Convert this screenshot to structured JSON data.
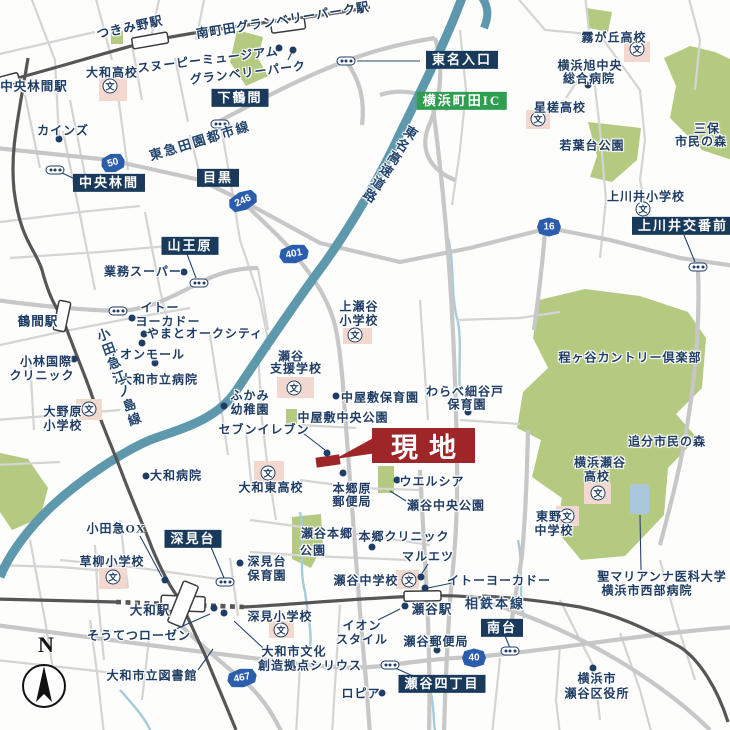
{
  "map": {
    "site": {
      "label": "現地"
    },
    "compass": {
      "label": "N"
    },
    "legend": {
      "school_char": "文"
    },
    "colors": {
      "site_red": "#9f2628",
      "label_navy": "#1e3c64",
      "box_navy": "#1a3a5c",
      "ic_green": "#2f9e50",
      "expressway_teal": "#5d98ac",
      "park_green": "#b4ca80",
      "road_gray": "#cfcfcf",
      "rail_gray": "#565656",
      "school_pink": "#f2d8ce",
      "hospital_blue": "#a9c6dd",
      "shield_blue": "#2b5dad"
    },
    "rail_road_labels": [
      {
        "text": "東急田園都市線",
        "x": 200,
        "y": 141,
        "rot": -17,
        "mode": "h"
      },
      {
        "text": "小田急江ノ島線",
        "x": 118,
        "y": 378,
        "rot": -20,
        "mode": "v"
      },
      {
        "text": "東名高速道路",
        "x": 389,
        "y": 164,
        "rot": 33,
        "mode": "v"
      },
      {
        "text": "相鉄本線",
        "x": 495,
        "y": 604,
        "rot": 0,
        "mode": "h"
      }
    ],
    "stations": [
      {
        "text": "つきみ野駅",
        "x": 130,
        "y": 28,
        "rot": -12
      },
      {
        "text": "南町田グランベリーパーク駅",
        "x": 283,
        "y": 21,
        "rot": -9
      },
      {
        "text": "中央林間駅",
        "x": 34,
        "y": 87,
        "rot": 0
      },
      {
        "text": "鶴間駅",
        "x": 38,
        "y": 322,
        "rot": 0
      },
      {
        "text": "大和駅",
        "x": 150,
        "y": 611,
        "rot": 0
      },
      {
        "text": "瀬谷駅",
        "x": 432,
        "y": 610,
        "rot": 0
      }
    ],
    "area_boxes": [
      {
        "text": "下鶴間",
        "x": 240,
        "y": 98,
        "style": "navy"
      },
      {
        "text": "東名入口",
        "x": 462,
        "y": 60,
        "style": "navy"
      },
      {
        "text": "横浜町田IC",
        "x": 462,
        "y": 101,
        "style": "green"
      },
      {
        "text": "中央林間",
        "x": 109,
        "y": 183,
        "style": "navy"
      },
      {
        "text": "目黒",
        "x": 218,
        "y": 178,
        "style": "navy"
      },
      {
        "text": "山王原",
        "x": 190,
        "y": 246,
        "style": "navy"
      },
      {
        "text": "上川井交番前",
        "x": 683,
        "y": 226,
        "style": "navy"
      },
      {
        "text": "深見台",
        "x": 193,
        "y": 539,
        "style": "navy"
      },
      {
        "text": "南台",
        "x": 502,
        "y": 628,
        "style": "navy"
      },
      {
        "text": "瀬谷四丁目",
        "x": 442,
        "y": 684,
        "style": "navy"
      }
    ],
    "route_shields": [
      {
        "num": "50",
        "x": 113,
        "y": 163,
        "rot": -15
      },
      {
        "num": "246",
        "x": 243,
        "y": 201,
        "rot": -25
      },
      {
        "num": "401",
        "x": 294,
        "y": 254,
        "rot": -12
      },
      {
        "num": "16",
        "x": 549,
        "y": 227,
        "rot": 0
      },
      {
        "num": "467",
        "x": 242,
        "y": 678,
        "rot": -12
      },
      {
        "num": "40",
        "x": 474,
        "y": 658,
        "rot": 0
      }
    ],
    "pois": [
      {
        "text": "スヌーピーミュージアム",
        "x": 208,
        "y": 60,
        "rot": -7
      },
      {
        "text": "グランベリーパーク",
        "x": 248,
        "y": 73,
        "rot": -7
      },
      {
        "text": "カインズ",
        "x": 63,
        "y": 131
      },
      {
        "text": "大和高校",
        "x": 112,
        "y": 73
      },
      {
        "text": "霧が丘高校",
        "x": 614,
        "y": 38
      },
      {
        "text": "横浜旭中央",
        "x": 590,
        "y": 66
      },
      {
        "text": "総合病院",
        "x": 589,
        "y": 79
      },
      {
        "text": "星槎高校",
        "x": 560,
        "y": 108
      },
      {
        "text": "若葉台公園",
        "x": 592,
        "y": 146
      },
      {
        "text": "三保",
        "x": 707,
        "y": 129
      },
      {
        "text": "市民の森",
        "x": 701,
        "y": 142
      },
      {
        "text": "上川井小学校",
        "x": 646,
        "y": 197
      },
      {
        "text": "業務スーパー",
        "x": 143,
        "y": 272
      },
      {
        "text": "イトー",
        "x": 160,
        "y": 308
      },
      {
        "text": "ヨーカドー",
        "x": 168,
        "y": 322
      },
      {
        "text": "やまとオークシティ",
        "x": 205,
        "y": 334
      },
      {
        "text": "イオンモール",
        "x": 146,
        "y": 355
      },
      {
        "text": "小林国際",
        "x": 46,
        "y": 362
      },
      {
        "text": "クリニック",
        "x": 42,
        "y": 376
      },
      {
        "text": "大和市立病院",
        "x": 159,
        "y": 380
      },
      {
        "text": "上瀬谷",
        "x": 359,
        "y": 307
      },
      {
        "text": "小学校",
        "x": 359,
        "y": 321
      },
      {
        "text": "瀬谷",
        "x": 291,
        "y": 357
      },
      {
        "text": "支援学校",
        "x": 296,
        "y": 369
      },
      {
        "text": "程ヶ谷カントリー倶楽部",
        "x": 630,
        "y": 358
      },
      {
        "text": "大野原",
        "x": 63,
        "y": 412
      },
      {
        "text": "小学校",
        "x": 63,
        "y": 426
      },
      {
        "text": "ふかみ",
        "x": 250,
        "y": 396
      },
      {
        "text": "幼稚園",
        "x": 250,
        "y": 410
      },
      {
        "text": "セブンイレブン",
        "x": 264,
        "y": 430
      },
      {
        "text": "中屋敷保育園",
        "x": 380,
        "y": 398
      },
      {
        "text": "中屋敷中央公園",
        "x": 343,
        "y": 418
      },
      {
        "text": "わらべ細谷戸",
        "x": 465,
        "y": 392
      },
      {
        "text": "保育園",
        "x": 467,
        "y": 405
      },
      {
        "text": "追分市民の森",
        "x": 667,
        "y": 442
      },
      {
        "text": "大和病院",
        "x": 176,
        "y": 476
      },
      {
        "text": "大和東高校",
        "x": 271,
        "y": 488
      },
      {
        "text": "本郷原",
        "x": 352,
        "y": 489
      },
      {
        "text": "郵便局",
        "x": 352,
        "y": 502
      },
      {
        "text": "ウエルシア",
        "x": 432,
        "y": 482
      },
      {
        "text": "瀬谷中央公園",
        "x": 446,
        "y": 506
      },
      {
        "text": "横浜瀬谷",
        "x": 600,
        "y": 463
      },
      {
        "text": "高校",
        "x": 597,
        "y": 477
      },
      {
        "text": "東野",
        "x": 549,
        "y": 517
      },
      {
        "text": "中学校",
        "x": 554,
        "y": 531
      },
      {
        "text": "小田急OX",
        "x": 116,
        "y": 529
      },
      {
        "text": "草柳小学校",
        "x": 112,
        "y": 562
      },
      {
        "text": "深見台",
        "x": 267,
        "y": 562
      },
      {
        "text": "保育園",
        "x": 267,
        "y": 576
      },
      {
        "text": "瀬谷本郷",
        "x": 327,
        "y": 534
      },
      {
        "text": "公園",
        "x": 313,
        "y": 551
      },
      {
        "text": "本郷クリニック",
        "x": 404,
        "y": 537
      },
      {
        "text": "マルエツ",
        "x": 428,
        "y": 557
      },
      {
        "text": "瀬谷中学校",
        "x": 366,
        "y": 581
      },
      {
        "text": "イトーヨーカドー",
        "x": 499,
        "y": 581
      },
      {
        "text": "聖マリアンナ医科大学",
        "x": 662,
        "y": 577
      },
      {
        "text": "横浜市西部病院",
        "x": 647,
        "y": 591
      },
      {
        "text": "そうてつローゼン",
        "x": 139,
        "y": 636
      },
      {
        "text": "深見小学校",
        "x": 280,
        "y": 617
      },
      {
        "text": "イオン",
        "x": 362,
        "y": 626
      },
      {
        "text": "スタイル",
        "x": 362,
        "y": 640
      },
      {
        "text": "瀬谷郵便局",
        "x": 436,
        "y": 642
      },
      {
        "text": "大和市立図書館",
        "x": 152,
        "y": 676
      },
      {
        "text": "大和市文化",
        "x": 294,
        "y": 652
      },
      {
        "text": "創造拠点シリウス",
        "x": 310,
        "y": 666
      },
      {
        "text": "ロピア",
        "x": 361,
        "y": 694
      },
      {
        "text": "横浜市",
        "x": 597,
        "y": 679
      },
      {
        "text": "瀬谷区役所",
        "x": 597,
        "y": 694
      }
    ],
    "dots": [
      {
        "x": 279,
        "y": 48
      },
      {
        "x": 293,
        "y": 50
      },
      {
        "x": 59,
        "y": 139
      },
      {
        "x": 588,
        "y": 85
      },
      {
        "x": 184,
        "y": 272
      },
      {
        "x": 132,
        "y": 318
      },
      {
        "x": 144,
        "y": 334
      },
      {
        "x": 142,
        "y": 343
      },
      {
        "x": 74,
        "y": 359
      },
      {
        "x": 155,
        "y": 363
      },
      {
        "x": 224,
        "y": 406
      },
      {
        "x": 336,
        "y": 396
      },
      {
        "x": 468,
        "y": 412
      },
      {
        "x": 327,
        "y": 453
      },
      {
        "x": 146,
        "y": 476
      },
      {
        "x": 343,
        "y": 473
      },
      {
        "x": 397,
        "y": 480
      },
      {
        "x": 372,
        "y": 547
      },
      {
        "x": 421,
        "y": 577
      },
      {
        "x": 425,
        "y": 588
      },
      {
        "x": 240,
        "y": 563
      },
      {
        "x": 165,
        "y": 580
      },
      {
        "x": 214,
        "y": 608
      },
      {
        "x": 224,
        "y": 613
      },
      {
        "x": 405,
        "y": 606
      },
      {
        "x": 437,
        "y": 650
      },
      {
        "x": 382,
        "y": 693
      },
      {
        "x": 593,
        "y": 668
      }
    ],
    "traffic_lights": [
      {
        "x": 346,
        "y": 61
      },
      {
        "x": 220,
        "y": 124
      },
      {
        "x": 55,
        "y": 170
      },
      {
        "x": 199,
        "y": 283
      },
      {
        "x": 698,
        "y": 267
      },
      {
        "x": 118,
        "y": 311
      },
      {
        "x": 225,
        "y": 582
      },
      {
        "x": 510,
        "y": 651
      },
      {
        "x": 390,
        "y": 665
      }
    ],
    "schools": [
      {
        "x": 110,
        "y": 86,
        "sq": [
          99,
          78,
          28,
          23
        ]
      },
      {
        "x": 637,
        "y": 49,
        "sq": [
          624,
          42,
          26,
          20
        ]
      },
      {
        "x": 538,
        "y": 119,
        "sq": [
          526,
          110,
          24,
          19
        ]
      },
      {
        "x": 643,
        "y": 209,
        "sq": null
      },
      {
        "x": 355,
        "y": 335,
        "sq": [
          343,
          328,
          29,
          16
        ]
      },
      {
        "x": 294,
        "y": 388,
        "sq": [
          277,
          377,
          37,
          21
        ]
      },
      {
        "x": 89,
        "y": 409,
        "sq": [
          76,
          399,
          26,
          21
        ]
      },
      {
        "x": 268,
        "y": 473,
        "sq": [
          254,
          461,
          30,
          23
        ]
      },
      {
        "x": 598,
        "y": 493,
        "sq": [
          584,
          483,
          27,
          21
        ]
      },
      {
        "x": 567,
        "y": 516,
        "sq": [
          556,
          506,
          23,
          20
        ]
      },
      {
        "x": 409,
        "y": 580,
        "sq": [
          396,
          570,
          23,
          19
        ]
      },
      {
        "x": 113,
        "y": 577,
        "sq": [
          99,
          568,
          28,
          21
        ]
      },
      {
        "x": 281,
        "y": 630,
        "sq": [
          269,
          621,
          25,
          17
        ]
      }
    ]
  }
}
